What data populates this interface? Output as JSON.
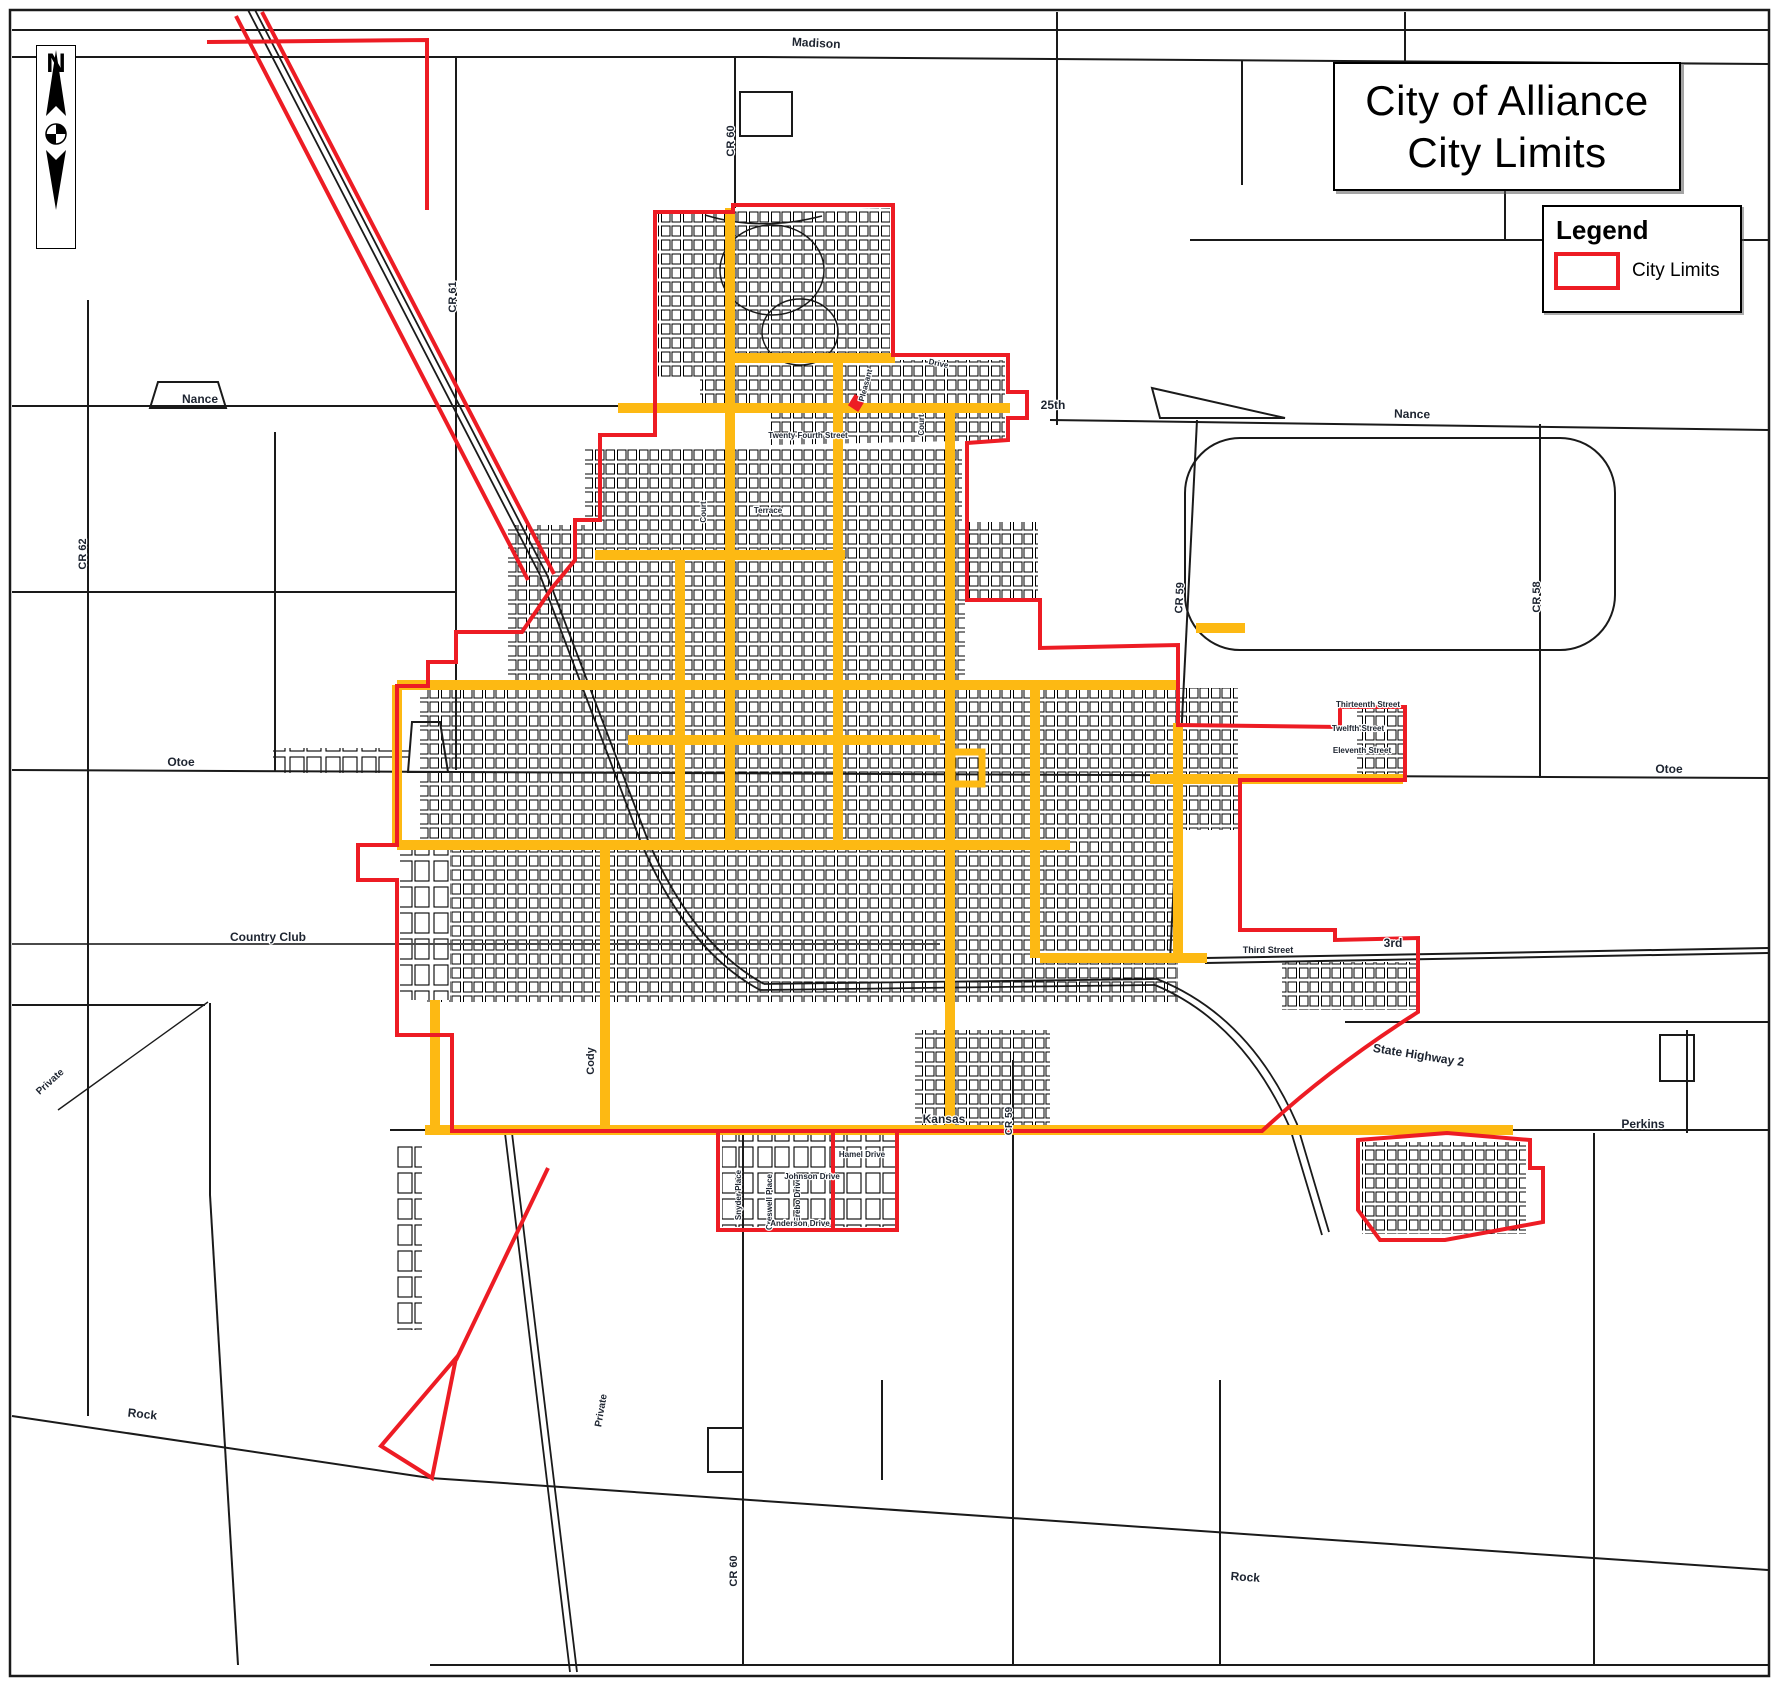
{
  "title": {
    "line1": "City of Alliance",
    "line2": "City Limits"
  },
  "legend": {
    "heading": "Legend",
    "items": [
      {
        "label": "City Limits",
        "swatch": "city-limits-outline"
      }
    ]
  },
  "north_arrow": {
    "label": "N"
  },
  "colors": {
    "city_limits": "#ED1C24",
    "major_streets": "#FDB913",
    "base_lines": "#111111",
    "background": "#FFFFFF"
  },
  "map": {
    "road_labels": [
      {
        "text": "Madison",
        "x": 816,
        "y": 47,
        "rot": 3,
        "size": 12
      },
      {
        "text": "CR 60",
        "x": 734,
        "y": 141,
        "rot": -90,
        "size": 11
      },
      {
        "text": "CR 61",
        "x": 456,
        "y": 297,
        "rot": -90,
        "size": 11
      },
      {
        "text": "Nance",
        "x": 200,
        "y": 403,
        "rot": 0,
        "size": 12
      },
      {
        "text": "Nance",
        "x": 1412,
        "y": 418,
        "rot": 1,
        "size": 12
      },
      {
        "text": "CR 62",
        "x": 86,
        "y": 554,
        "rot": -90,
        "size": 11
      },
      {
        "text": "CR 59",
        "x": 1183,
        "y": 598,
        "rot": -87,
        "size": 11
      },
      {
        "text": "CR 58",
        "x": 1540,
        "y": 597,
        "rot": -90,
        "size": 11
      },
      {
        "text": "25th",
        "x": 1053,
        "y": 409,
        "rot": 0,
        "size": 12
      },
      {
        "text": "Otoe",
        "x": 181,
        "y": 766,
        "rot": 0,
        "size": 12
      },
      {
        "text": "Otoe",
        "x": 1669,
        "y": 773,
        "rot": 0,
        "size": 12
      },
      {
        "text": "Country Club",
        "x": 268,
        "y": 941,
        "rot": 0,
        "size": 12
      },
      {
        "text": "3rd",
        "x": 1393,
        "y": 947,
        "rot": 0,
        "size": 12
      },
      {
        "text": "Third Street",
        "x": 1268,
        "y": 953,
        "rot": 0,
        "size": 9
      },
      {
        "text": "State Highway 2",
        "x": 1418,
        "y": 1059,
        "rot": 9,
        "size": 12
      },
      {
        "text": "Kansas",
        "x": 944,
        "y": 1123,
        "rot": 0,
        "size": 12
      },
      {
        "text": "Perkins",
        "x": 1643,
        "y": 1128,
        "rot": 0,
        "size": 12
      },
      {
        "text": "CR 59",
        "x": 1012,
        "y": 1121,
        "rot": -90,
        "size": 10
      },
      {
        "text": "Private",
        "x": 52,
        "y": 1084,
        "rot": -42,
        "size": 10
      },
      {
        "text": "Cody",
        "x": 594,
        "y": 1061,
        "rot": -90,
        "size": 11
      },
      {
        "text": "Private",
        "x": 604,
        "y": 1411,
        "rot": -80,
        "size": 10
      },
      {
        "text": "CR 60",
        "x": 737,
        "y": 1571,
        "rot": -90,
        "size": 11
      },
      {
        "text": "Rock",
        "x": 142,
        "y": 1418,
        "rot": 6,
        "size": 12
      },
      {
        "text": "Rock",
        "x": 1245,
        "y": 1581,
        "rot": 4,
        "size": 12
      },
      {
        "text": "Thirteenth Street",
        "x": 1368,
        "y": 707,
        "rot": 0,
        "size": 8
      },
      {
        "text": "Twelfth Street",
        "x": 1358,
        "y": 731,
        "rot": 0,
        "size": 8
      },
      {
        "text": "Eleventh Street",
        "x": 1362,
        "y": 753,
        "rot": 0,
        "size": 8
      },
      {
        "text": "Snyder Place",
        "x": 741,
        "y": 1195,
        "rot": -90,
        "size": 8
      },
      {
        "text": "Creswell Place",
        "x": 772,
        "y": 1202,
        "rot": -90,
        "size": 8
      },
      {
        "text": "Erebo Drive",
        "x": 800,
        "y": 1200,
        "rot": -90,
        "size": 8
      },
      {
        "text": "Johnson Drive",
        "x": 812,
        "y": 1179,
        "rot": 0,
        "size": 8
      },
      {
        "text": "Anderson Drive",
        "x": 800,
        "y": 1226,
        "rot": 0,
        "size": 8
      },
      {
        "text": "Hamel Drive",
        "x": 862,
        "y": 1157,
        "rot": 0,
        "size": 8
      },
      {
        "text": "Court",
        "x": 924,
        "y": 425,
        "rot": -90,
        "size": 8
      },
      {
        "text": "Drive",
        "x": 938,
        "y": 366,
        "rot": 12,
        "size": 8
      },
      {
        "text": "Terrace",
        "x": 768,
        "y": 513,
        "rot": 0,
        "size": 8
      },
      {
        "text": "Court",
        "x": 706,
        "y": 512,
        "rot": -90,
        "size": 8
      },
      {
        "text": "Pleasant",
        "x": 868,
        "y": 386,
        "rot": -75,
        "size": 8
      },
      {
        "text": "Twenty Fourth Street",
        "x": 808,
        "y": 438,
        "rot": 0,
        "size": 8
      }
    ]
  }
}
